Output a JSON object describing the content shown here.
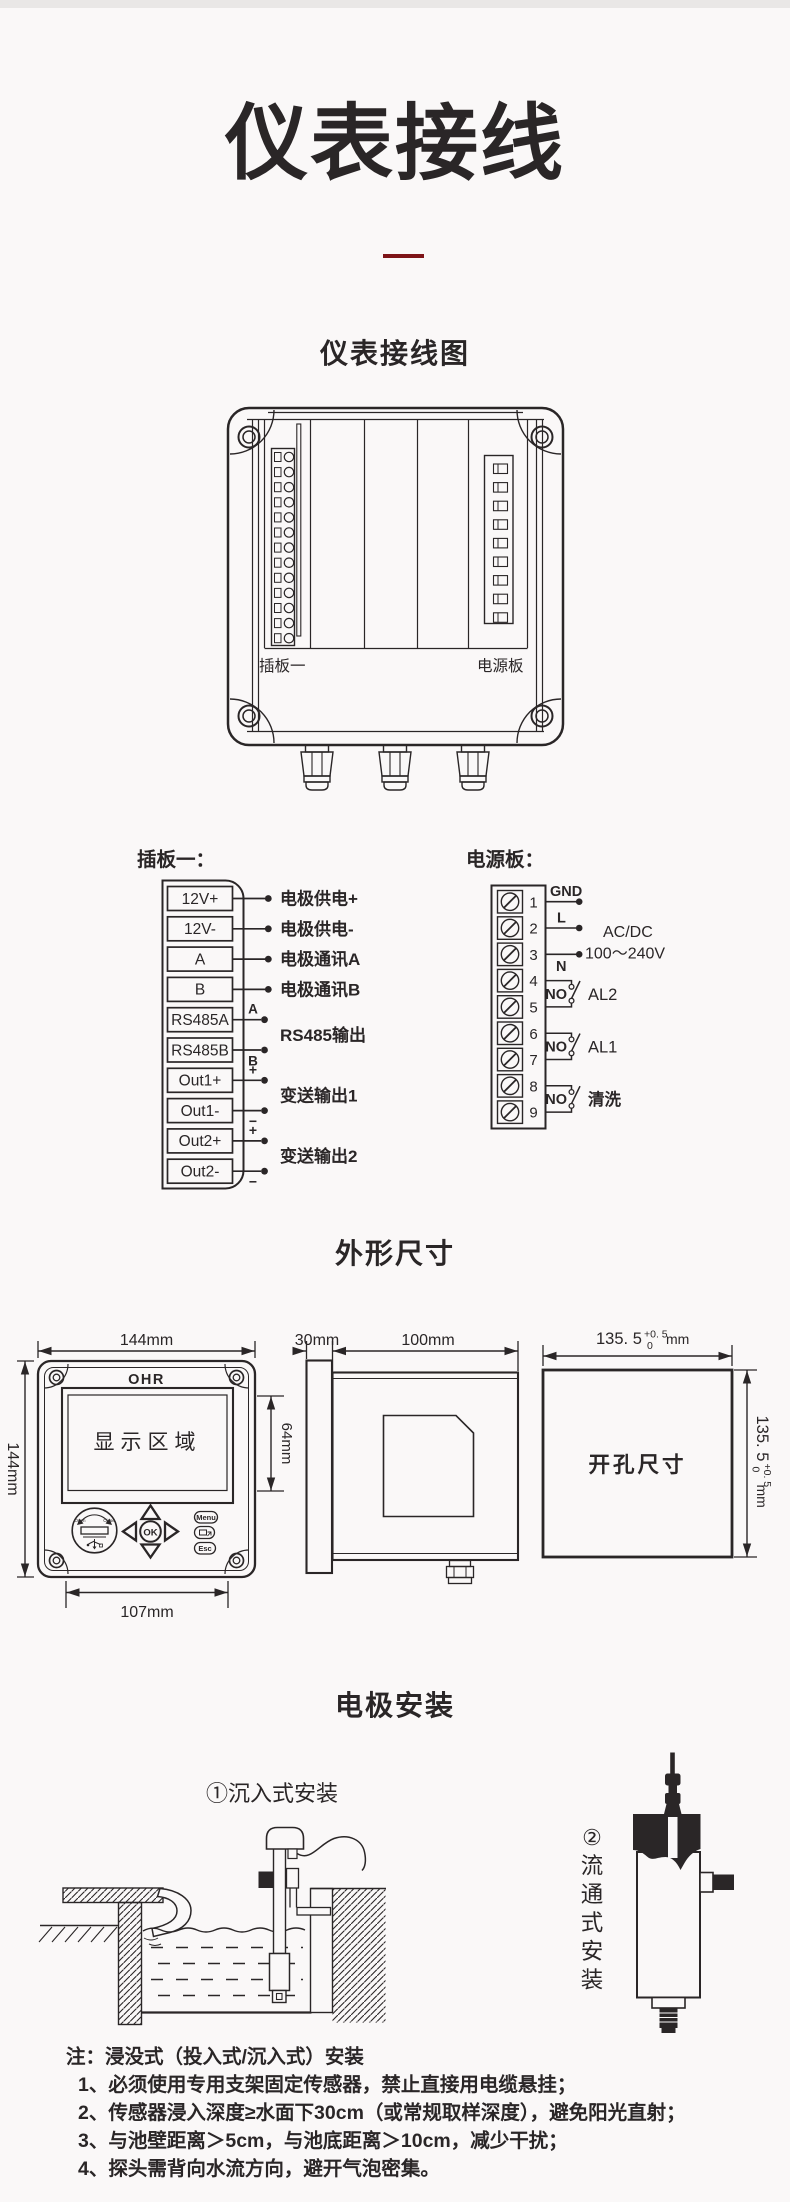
{
  "page": {
    "title": "仪表接线"
  },
  "theme": {
    "bg": "#faf8f8",
    "strip": "#e9e7e6",
    "ink": "#2a2627",
    "accent": "#7e1418"
  },
  "wiring": {
    "heading": "仪表接线图",
    "board1_label": "插板一",
    "power_label": "电源板"
  },
  "board1": {
    "heading": "插板一：",
    "terminals": [
      "12V+",
      "12V-",
      "A",
      "B",
      "RS485A",
      "RS485B",
      "Out1+",
      "Out1-",
      "Out2+",
      "Out2-"
    ],
    "conn": {
      "c0": "电极供电+",
      "c1": "电极供电-",
      "c2": "电极通讯A",
      "c3": "电极通讯B",
      "rs485": "RS485输出",
      "rs485_a": "A",
      "rs485_b": "B",
      "out1": "变送输出1",
      "out2": "变送输出2",
      "plus": "+",
      "minus": "−"
    }
  },
  "power": {
    "heading": "电源板：",
    "terminals": [
      "1",
      "2",
      "3",
      "4",
      "5",
      "6",
      "7",
      "8",
      "9"
    ],
    "gnd": "GND",
    "l": "L",
    "n": "N",
    "acdc": "AC/DC",
    "voltage": "100～240V",
    "no": "NO",
    "al2": "AL2",
    "al1": "AL1",
    "wash": "清洗"
  },
  "dims": {
    "heading": "外形尺寸",
    "front": {
      "brand": "OHR",
      "display": "显示区域",
      "w": "144mm",
      "h": "144mm",
      "disp_h": "64mm",
      "bw": "107mm",
      "ok": "OK",
      "menu": "Menu",
      "esc": "Esc",
      "open": "Open",
      "close": "Close"
    },
    "side": {
      "bezel": "30mm",
      "depth": "100mm"
    },
    "cutout": {
      "label": "开孔尺寸",
      "base": "135. 5",
      "sup": "+0. 5",
      "sub": "0",
      "unit": "mm"
    }
  },
  "install": {
    "heading": "电极安装",
    "submerged": "①沉入式安装",
    "flow": [
      "②",
      "流",
      "通",
      "式",
      "安",
      "装"
    ],
    "note_title": "注：浸没式（投入式/沉入式）安装",
    "notes": [
      "1、必须使用专用支架固定传感器，禁止直接用电缆悬挂；",
      "2、传感器浸入深度≥水面下30cm（或常规取样深度），避免阳光直射；",
      "3、与池壁距离＞5cm，与池底距离＞10cm，减少干扰；",
      "4、探头需背向水流方向，避开气泡密集。"
    ]
  }
}
